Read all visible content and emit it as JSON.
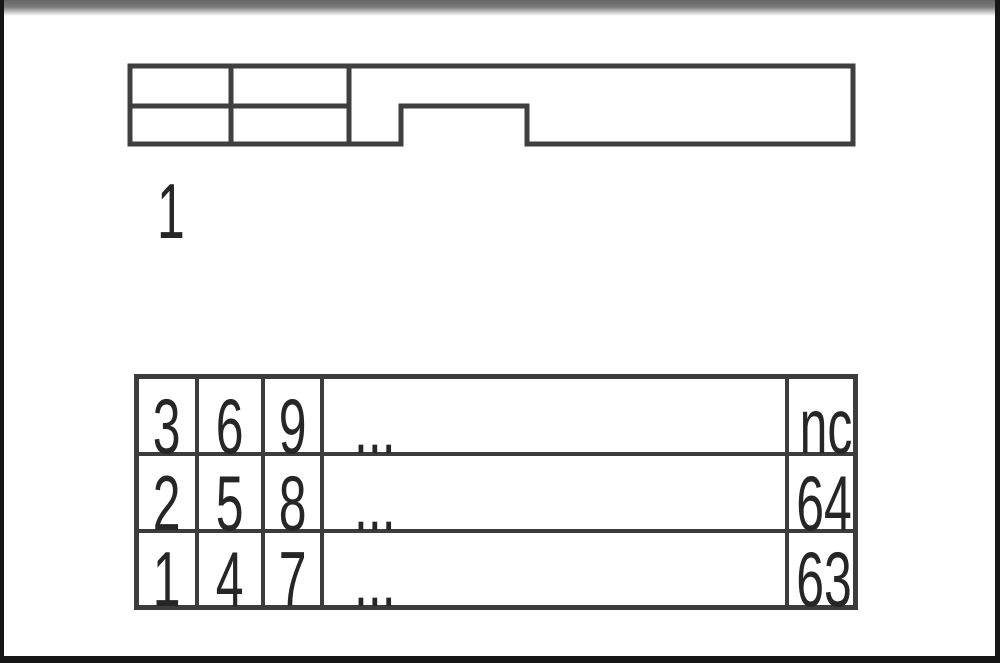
{
  "figure": {
    "kind": "connector-pinout-drawing",
    "pin1_label": "1",
    "line_color": "#3c3c3c",
    "top_bar_color": "#656565",
    "frame_color": "#161616"
  },
  "pin_table": {
    "rows": [
      [
        "3",
        "6",
        "9",
        "...",
        "nc"
      ],
      [
        "2",
        "5",
        "8",
        "...",
        "64"
      ],
      [
        "1",
        "4",
        "7",
        "...",
        "63"
      ]
    ]
  }
}
